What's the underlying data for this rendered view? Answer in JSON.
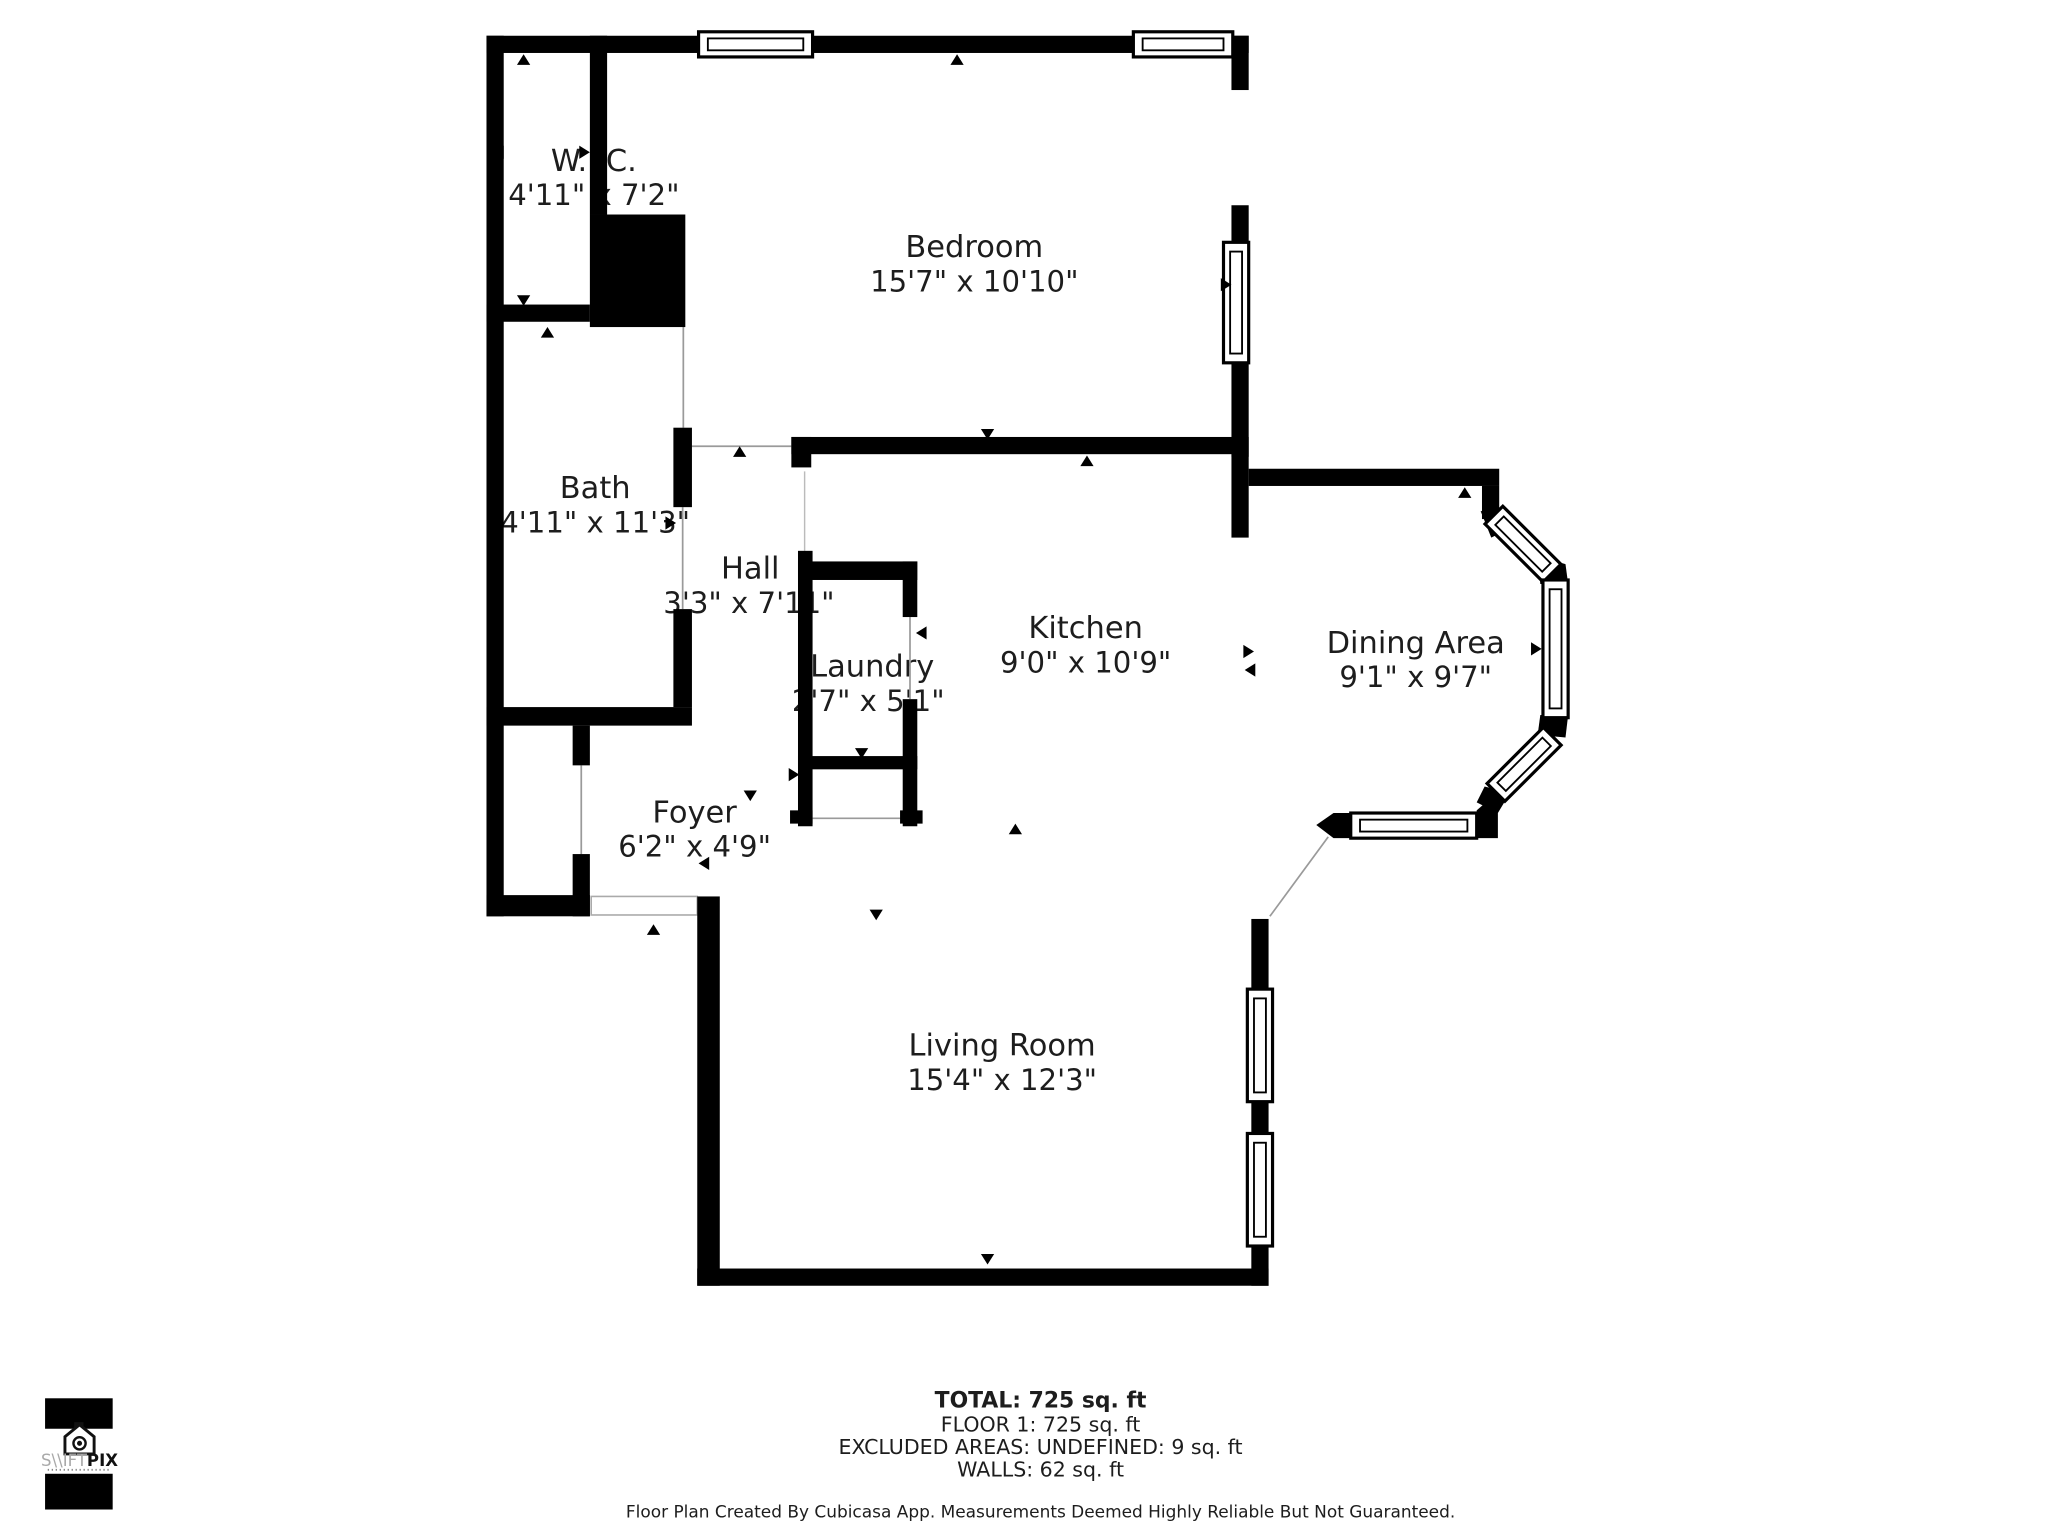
{
  "rooms": [
    {
      "id": "wic",
      "name": "W.I.C.",
      "dims": "4'11\" x 7'2\""
    },
    {
      "id": "bedroom",
      "name": "Bedroom",
      "dims": "15'7\" x 10'10\""
    },
    {
      "id": "bath",
      "name": "Bath",
      "dims": "4'11\" x 11'3\""
    },
    {
      "id": "hall",
      "name": "Hall",
      "dims": "3'3\" x 7'11\""
    },
    {
      "id": "laundry",
      "name": "Laundry",
      "dims": "2'7\" x 5'1\""
    },
    {
      "id": "kitchen",
      "name": "Kitchen",
      "dims": "9'0\" x 10'9\""
    },
    {
      "id": "dining",
      "name": "Dining Area",
      "dims": "9'1\" x 9'7\""
    },
    {
      "id": "foyer",
      "name": "Foyer",
      "dims": "6'2\" x 4'9\""
    },
    {
      "id": "living",
      "name": "Living Room",
      "dims": "15'4\" x 12'3\""
    }
  ],
  "summary": {
    "total": "TOTAL: 725 sq. ft",
    "floor1": "FLOOR 1: 725 sq. ft",
    "excluded": "EXCLUDED AREAS: UNDEFINED: 9 sq. ft",
    "walls": "WALLS: 62 sq. ft"
  },
  "disclaimer": "Floor Plan Created By Cubicasa App. Measurements Deemed Highly Reliable But Not Guaranteed.",
  "logo": {
    "brand_left": "S\\\\IFT",
    "brand_right": "PIX"
  },
  "colors": {
    "wall": "#000000",
    "text": "#1d1d1d",
    "opening_line": "#9a9a9a",
    "background": "#ffffff"
  }
}
